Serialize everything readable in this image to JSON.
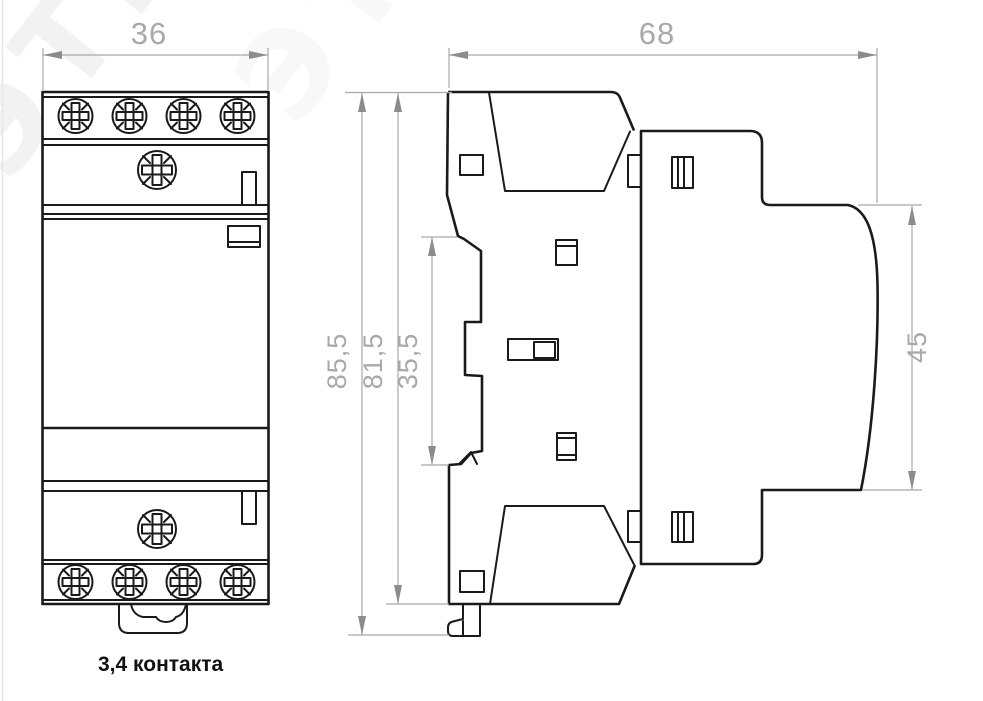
{
  "drawing": {
    "watermark": "ЭТМ",
    "caption": "3,4 контакта",
    "dimensions": {
      "front_width": "36",
      "side_depth": "68",
      "height_total": "85,5",
      "height_body": "81,5",
      "height_din_notch": "35,5",
      "height_cover": "45"
    },
    "colors": {
      "line": "#1a1a1a",
      "dimension_line": "#a9a9a9",
      "arrow": "#8c8c8c",
      "caption_text": "#111111",
      "background": "#ffffff"
    }
  }
}
